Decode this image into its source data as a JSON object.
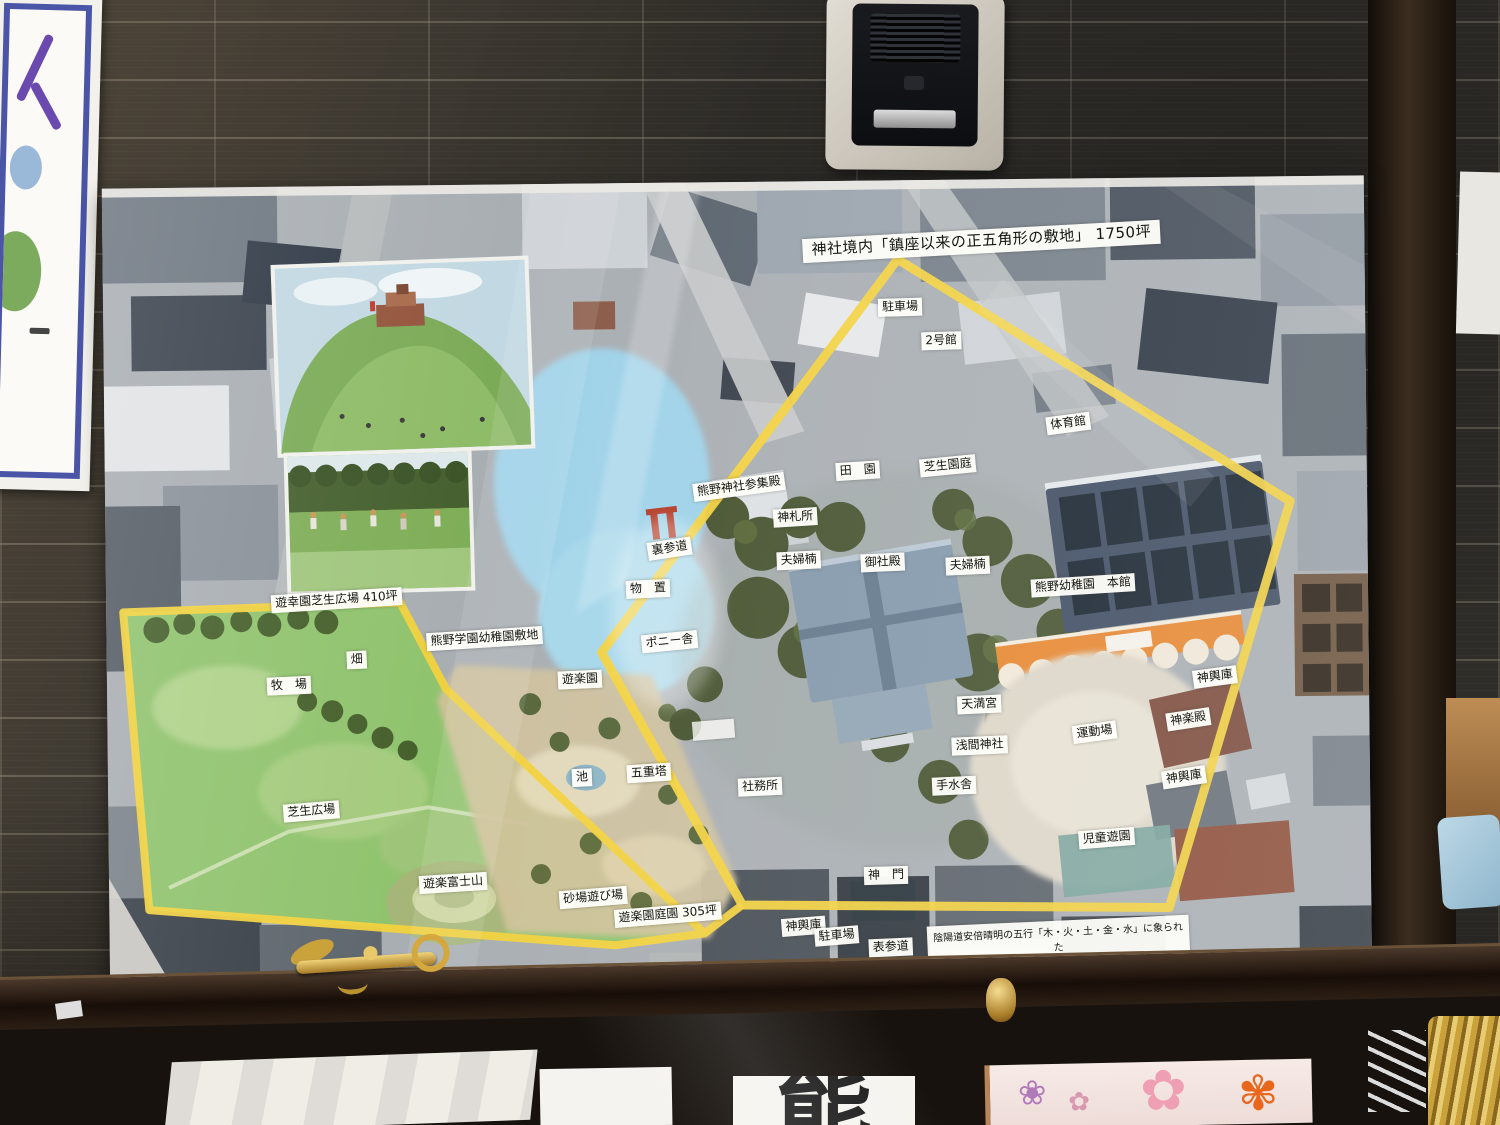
{
  "poster": {
    "title": "神社境内「鎮座以来の正五角形の敷地」 1750坪",
    "labels": [
      "駐車場",
      "2号館",
      "体育館",
      "芝生園庭",
      "田　園",
      "熊野神社参集殿",
      "神札所",
      "裏参道",
      "物　置",
      "夫婦楠",
      "御社殿",
      "夫婦楠",
      "熊野幼稚園　本館",
      "ポニー舎",
      "遊楽園",
      "神輿庫",
      "天満宮",
      "神楽殿",
      "運動場",
      "浅間神社",
      "池",
      "五重塔",
      "神輿庫",
      "社務所",
      "手水舎",
      "児童遊園",
      "神　門",
      "神輿庫",
      "駐車場",
      "表参道",
      "遊幸園芝生広場 410坪",
      "熊野学園幼稚園敷地",
      "畑",
      "牧　場",
      "芝生広場",
      "遊楽富士山",
      "砂場遊び場",
      "遊楽園庭園 305坪"
    ],
    "caption": {
      "line1": "陰陽道安倍晴明の五行「木・火・土・金・水」に象られた",
      "line2": "神社境内「鎮座以来の正五角形の敷地」"
    }
  },
  "display_case": {
    "card_character": "熊"
  },
  "icons": {
    "plum_blossom": "❀",
    "cherry_blossom": "✿",
    "orange_flower": "✾"
  },
  "colors": {
    "pentagon_outline": "#f3d23e",
    "label_background": "#fdfdf8"
  }
}
